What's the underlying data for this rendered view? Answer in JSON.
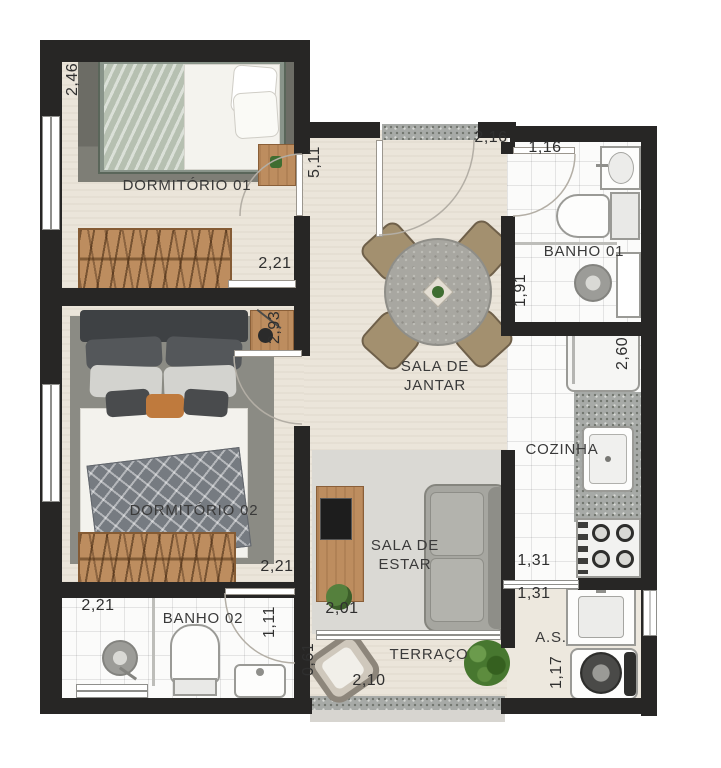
{
  "labels": {
    "dormitorio01": "DORMITÓRIO 01",
    "dormitorio02": "DORMITÓRIO 02",
    "banho01": "BANHO 01",
    "banho02": "BANHO 02",
    "sala_jantar": "SALA DE JANTAR",
    "sala_estar": "SALA DE ESTAR",
    "cozinha": "COZINHA",
    "terraco": "TERRAÇO",
    "area_servico": "A.S."
  },
  "dims": {
    "dorm1_largura": "2,46",
    "dorm1_porta": "2,21",
    "jantar_comprimento": "5,11",
    "jantar_largura": "2,16",
    "banho1_largura": "1,16",
    "banho1_comprimento": "1,91",
    "dorm2_comprimento": "2,93",
    "dorm2_porta": "2,21",
    "banho2_largura": "2,21",
    "banho2_porta": "1,11",
    "cozinha_comprimento": "2,60",
    "cozinha_largura": "1,31",
    "as_largura": "1,31",
    "estar_largura": "2,01",
    "terraco_profundidade": "0,61",
    "terraco_largura": "2,10",
    "as_comprimento": "1,17"
  },
  "colors": {
    "wall": "#272625",
    "floor_beige": "#ebe5da",
    "tile_white": "#fbfbfa",
    "wood": "#bd8d5f",
    "rug_dark": "#6c6c65",
    "rug_medium": "#8b8b84",
    "rug_light": "#dad9d4",
    "plant_green": "#4c7f3a"
  }
}
